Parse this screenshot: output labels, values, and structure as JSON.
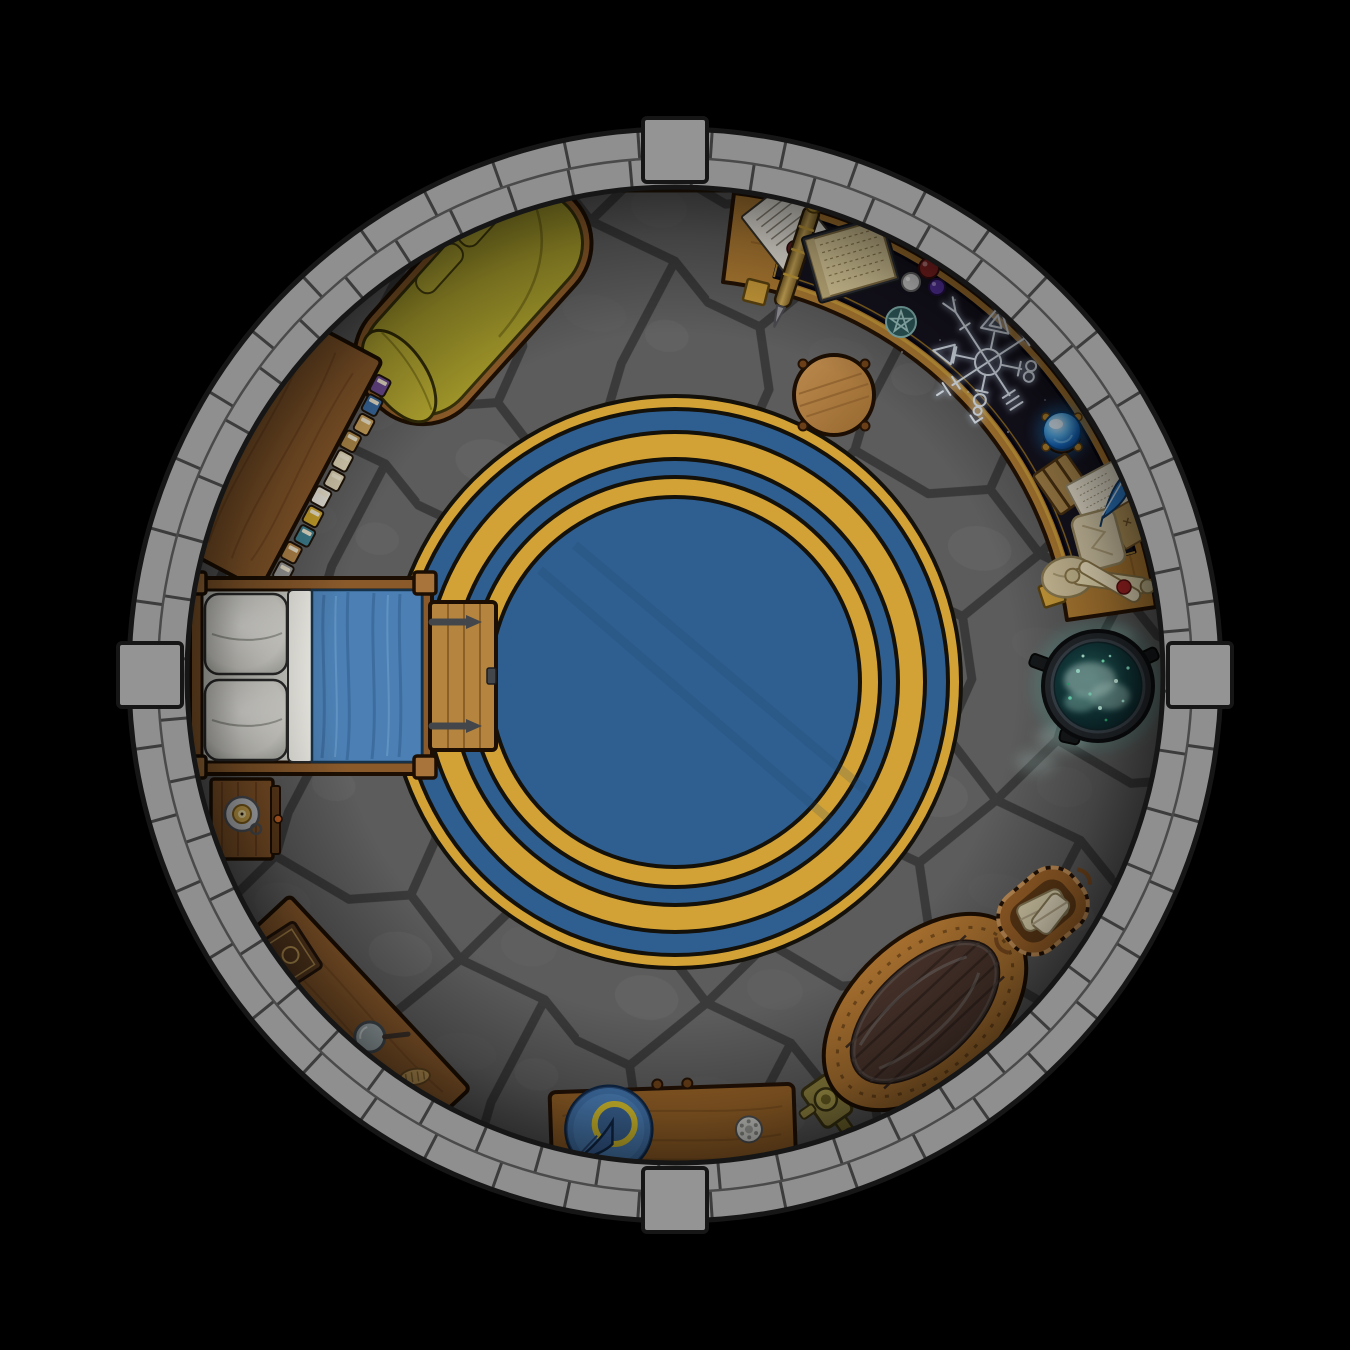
{
  "meta": {
    "title": "Wizard Tower - Circular Chamber",
    "style": "top-down fantasy battle map",
    "visible_text": "none"
  },
  "palette": {
    "background": "#000000",
    "wall_brick": "#8f8f8f",
    "wall_outline": "#161616",
    "floor_stone": "#5c5c5c",
    "floor_crack": "#3a3a3a",
    "rug_gold": "#d2a236",
    "rug_blue": "#2f5f90",
    "rug_outline": "#14100a",
    "wood_light": "#b07c33",
    "wood_mid": "#8a5a2b",
    "wood_dark": "#6b4018",
    "couch_olive": "#a1972a",
    "bed_blanket_blue": "#4c80b4",
    "pillow_white": "#eceae4",
    "desk_surface_navy": "#15121e",
    "desk_trim_gold": "#c99b3a",
    "sigil_glow": "#e8f0fa",
    "crystal_ball_blue": "#2286d8",
    "cauldron_brew_teal": "#55dcc6",
    "hat_blue": "#4f86c2",
    "hat_band_yellow": "#e3cb30",
    "tub_rim": "#a8702f",
    "tub_planks": "#4a342c"
  },
  "room": {
    "shape": "circle",
    "wall": "double course stone brick ring",
    "buttresses": 4,
    "buttress_positions": [
      "north",
      "west",
      "east",
      "south"
    ],
    "floor": "gray flagstone"
  },
  "rug": {
    "bands_outer_to_inner": [
      "gold",
      "blue",
      "gold",
      "blue",
      "gold",
      "blue-center"
    ]
  },
  "bookshelf": {
    "book_colors": [
      "#6b4a8e",
      "#3a6a9e",
      "#c8a05a",
      "#b08a4a",
      "#e0d6b8",
      "#d8cdb0",
      "#e8e4da",
      "#c8a22c",
      "#3f7f8e",
      "#b5874a",
      "#9a9a9a",
      "#a03030"
    ]
  },
  "furniture": [
    {
      "id": "chaise-couch",
      "label": "olive chaise lounge",
      "position": "north-northwest"
    },
    {
      "id": "bookshelf",
      "label": "bookshelf lined with books",
      "position": "west-northwest"
    },
    {
      "id": "bed",
      "label": "bed with blue blanket and two white pillows",
      "position": "west"
    },
    {
      "id": "storage-chest",
      "label": "wooden chest with iron hinges at foot of bed",
      "position": "west"
    },
    {
      "id": "nightstand",
      "label": "nightstand with candle on pewter dish",
      "position": "west-southwest"
    },
    {
      "id": "workbench",
      "label": "work desk with tome, magnifying glass and brush",
      "position": "southwest"
    },
    {
      "id": "side-table",
      "label": "table with wizard hat and silver brooch",
      "position": "south"
    },
    {
      "id": "water-pump",
      "label": "brass water pump",
      "position": "south-southeast"
    },
    {
      "id": "bathtub",
      "label": "oval wooden bathtub",
      "position": "southeast"
    },
    {
      "id": "towel-basket",
      "label": "rope basket with folded towels",
      "position": "east-southeast"
    },
    {
      "id": "cauldron",
      "label": "iron cauldron with glowing teal brew",
      "position": "east"
    },
    {
      "id": "stool",
      "label": "round wooden stool",
      "position": "center-northeast"
    },
    {
      "id": "arcane-desk",
      "label": "curved arcane desk with dark inlay",
      "position": "northeast"
    },
    {
      "id": "wall-shelf",
      "label": "small wooden wall ledge",
      "position": "north"
    },
    {
      "id": "round-rug",
      "label": "large round rug, blue with gold rings",
      "position": "center"
    }
  ],
  "arcane_desk_items": [
    "sealed letter with dark wax seal",
    "ornate scroll case",
    "parchment on writing board",
    "red orb",
    "silver orb",
    "purple orb",
    "pentacle medallion",
    "glowing rune sigil",
    "blue crystal ball on clawed stand",
    "strapped journal",
    "loose written papers",
    "blue feather quill",
    "folded map",
    "crumpled parchment",
    "cloth sack",
    "rolled scrolls with red wax seal"
  ],
  "sigil": {
    "arms": 8,
    "glyphs": [
      "triangle",
      "circle",
      "double-loop",
      "comb-bars",
      "orb-staff",
      "ladder-bars",
      "arrow-triangle",
      "fork"
    ]
  }
}
